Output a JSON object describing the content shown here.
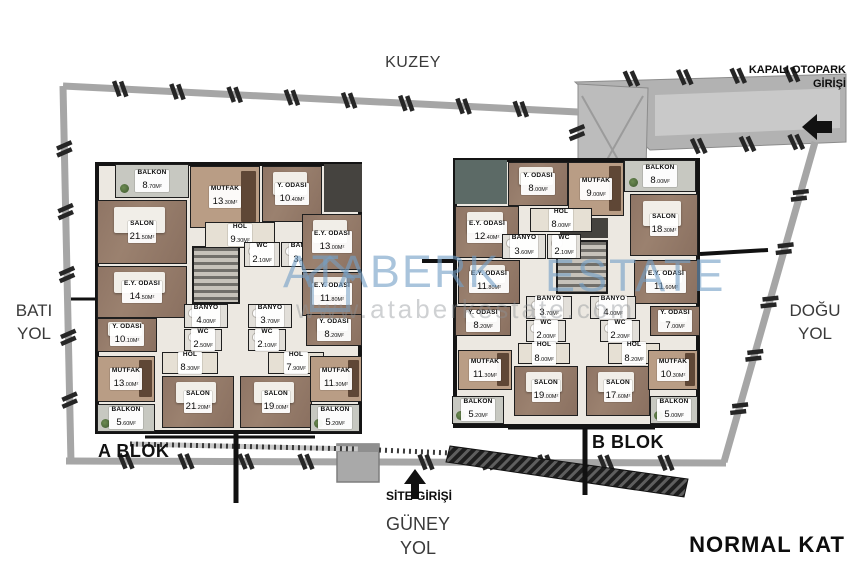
{
  "plan": {
    "title": "NORMAL KAT"
  },
  "directions": {
    "north": "KUZEY",
    "south_line1": "GÜNEY",
    "south_line2": "YOL",
    "west_line1": "BATI",
    "west_line2": "YOL",
    "east_line1": "DOĞU",
    "east_line2": "YOL"
  },
  "entrances": {
    "parking_line1": "KAPALI OTOPARK",
    "parking_line2": "GİRİŞİ",
    "site": "SİTE GİRİŞİ"
  },
  "watermark": {
    "brand": "ATABERK",
    "brand2": "ESTATE",
    "url": "www.ataberkestate.com",
    "color": "#74a0c6"
  },
  "blocks": [
    {
      "name": "A BLOK",
      "label_pos": {
        "x": 98,
        "y": 441
      },
      "outline": {
        "x": 95,
        "y": 162,
        "w": 267,
        "h": 272
      },
      "core": {
        "x": 192,
        "y": 246,
        "w": 48,
        "h": 58
      },
      "rooms": [
        {
          "n": "BALKON",
          "a": "8.70M²",
          "x": 115,
          "y": 164,
          "w": 74,
          "h": 34,
          "t": "balcony"
        },
        {
          "n": "MUTFAK",
          "a": "13.30M²",
          "x": 190,
          "y": 166,
          "w": 70,
          "h": 62,
          "t": "kitchen"
        },
        {
          "n": "Y. ODASI",
          "a": "10.40M²",
          "x": 262,
          "y": 166,
          "w": 60,
          "h": 56,
          "t": "wood"
        },
        {
          "n": "SALON",
          "a": "21.50M²",
          "x": 97,
          "y": 200,
          "w": 90,
          "h": 64,
          "t": "wood"
        },
        {
          "n": "HOL",
          "a": "9.30M²",
          "x": 205,
          "y": 222,
          "w": 70,
          "h": 26,
          "t": "hall"
        },
        {
          "n": "WC",
          "a": "2.10M²",
          "x": 244,
          "y": 242,
          "w": 36,
          "h": 25,
          "t": "wet"
        },
        {
          "n": "BANYO",
          "a": "3.40M²",
          "x": 281,
          "y": 242,
          "w": 44,
          "h": 25,
          "t": "wet"
        },
        {
          "n": "E.Y. ODASI",
          "a": "13.00M²",
          "x": 302,
          "y": 214,
          "w": 60,
          "h": 56,
          "t": "wood"
        },
        {
          "n": "E.Y. ODASI",
          "a": "14.50M²",
          "x": 97,
          "y": 266,
          "w": 90,
          "h": 52,
          "t": "wood"
        },
        {
          "n": "E.Y. ODASI",
          "a": "11.80M²",
          "x": 302,
          "y": 272,
          "w": 60,
          "h": 44,
          "t": "wood"
        },
        {
          "n": "Y. ODASI",
          "a": "10.10M²",
          "x": 97,
          "y": 318,
          "w": 60,
          "h": 34,
          "t": "wood"
        },
        {
          "n": "BANYO",
          "a": "4.00M²",
          "x": 184,
          "y": 304,
          "w": 44,
          "h": 24,
          "t": "wet"
        },
        {
          "n": "WC",
          "a": "2.50M²",
          "x": 184,
          "y": 329,
          "w": 38,
          "h": 22,
          "t": "wet"
        },
        {
          "n": "HOL",
          "a": "8.30M²",
          "x": 162,
          "y": 352,
          "w": 56,
          "h": 22,
          "t": "hall"
        },
        {
          "n": "BANYO",
          "a": "3.70M²",
          "x": 248,
          "y": 304,
          "w": 44,
          "h": 24,
          "t": "wet"
        },
        {
          "n": "WC",
          "a": "2.10M²",
          "x": 248,
          "y": 329,
          "w": 38,
          "h": 22,
          "t": "wet"
        },
        {
          "n": "HOL",
          "a": "7.90M²",
          "x": 268,
          "y": 352,
          "w": 56,
          "h": 22,
          "t": "hall"
        },
        {
          "n": "Y. ODASI",
          "a": "8.20M²",
          "x": 306,
          "y": 314,
          "w": 56,
          "h": 32,
          "t": "wood"
        },
        {
          "n": "MUTFAK",
          "a": "13.00M²",
          "x": 97,
          "y": 356,
          "w": 58,
          "h": 46,
          "t": "kitchen"
        },
        {
          "n": "SALON",
          "a": "21.20M²",
          "x": 162,
          "y": 376,
          "w": 72,
          "h": 52,
          "t": "wood"
        },
        {
          "n": "SALON",
          "a": "19.00M²",
          "x": 240,
          "y": 376,
          "w": 72,
          "h": 52,
          "t": "wood"
        },
        {
          "n": "MUTFAK",
          "a": "11.30M²",
          "x": 310,
          "y": 356,
          "w": 52,
          "h": 46,
          "t": "kitchen"
        },
        {
          "n": "BALKON",
          "a": "5.60M²",
          "x": 97,
          "y": 404,
          "w": 58,
          "h": 28,
          "t": "balcony"
        },
        {
          "n": "BALKON",
          "a": "5.20M²",
          "x": 310,
          "y": 404,
          "w": 50,
          "h": 28,
          "t": "balcony"
        }
      ]
    },
    {
      "name": "B BLOK",
      "label_pos": {
        "x": 592,
        "y": 432
      },
      "outline": {
        "x": 453,
        "y": 158,
        "w": 247,
        "h": 270
      },
      "core": {
        "x": 556,
        "y": 240,
        "w": 52,
        "h": 54
      },
      "rooms": [
        {
          "n": "Y. ODASI",
          "a": "8.00M²",
          "x": 508,
          "y": 162,
          "w": 60,
          "h": 44,
          "t": "wood"
        },
        {
          "n": "MUTFAK",
          "a": "9.00M²",
          "x": 568,
          "y": 162,
          "w": 56,
          "h": 54,
          "t": "kitchen"
        },
        {
          "n": "BALKON",
          "a": "8.00M²",
          "x": 624,
          "y": 160,
          "w": 72,
          "h": 32,
          "t": "balcony"
        },
        {
          "n": "E.Y. ODASI",
          "a": "12.40M²",
          "x": 455,
          "y": 206,
          "w": 64,
          "h": 52,
          "t": "wood"
        },
        {
          "n": "HOL",
          "a": "8.00M²",
          "x": 530,
          "y": 208,
          "w": 62,
          "h": 24,
          "t": "hall"
        },
        {
          "n": "BANYO",
          "a": "3.60M²",
          "x": 502,
          "y": 234,
          "w": 44,
          "h": 25,
          "t": "wet"
        },
        {
          "n": "WC",
          "a": "2.10M²",
          "x": 547,
          "y": 234,
          "w": 34,
          "h": 25,
          "t": "wet"
        },
        {
          "n": "SALON",
          "a": "18.30M²",
          "x": 630,
          "y": 194,
          "w": 68,
          "h": 62,
          "t": "wood"
        },
        {
          "n": "E.Y. ODASI",
          "a": "11.80M²",
          "x": 458,
          "y": 260,
          "w": 62,
          "h": 44,
          "t": "wood"
        },
        {
          "n": "E.Y. ODASI",
          "a": "11.60M²",
          "x": 634,
          "y": 260,
          "w": 64,
          "h": 44,
          "t": "wood"
        },
        {
          "n": "Y. ODASI",
          "a": "8.20M²",
          "x": 455,
          "y": 306,
          "w": 56,
          "h": 30,
          "t": "wood"
        },
        {
          "n": "BANYO",
          "a": "3.70M²",
          "x": 526,
          "y": 296,
          "w": 46,
          "h": 23,
          "t": "wet"
        },
        {
          "n": "WC",
          "a": "2.00M²",
          "x": 526,
          "y": 320,
          "w": 40,
          "h": 22,
          "t": "wet"
        },
        {
          "n": "HOL",
          "a": "8.00M²",
          "x": 518,
          "y": 343,
          "w": 52,
          "h": 21,
          "t": "hall"
        },
        {
          "n": "BANYO",
          "a": "4.00M²",
          "x": 590,
          "y": 296,
          "w": 46,
          "h": 23,
          "t": "wet"
        },
        {
          "n": "WC",
          "a": "2.20M²",
          "x": 600,
          "y": 320,
          "w": 40,
          "h": 22,
          "t": "wet"
        },
        {
          "n": "HOL",
          "a": "8.20M²",
          "x": 608,
          "y": 343,
          "w": 52,
          "h": 21,
          "t": "hall"
        },
        {
          "n": "Y. ODASI",
          "a": "7.00M²",
          "x": 650,
          "y": 306,
          "w": 50,
          "h": 30,
          "t": "wood"
        },
        {
          "n": "MUTFAK",
          "a": "11.30M²",
          "x": 458,
          "y": 350,
          "w": 54,
          "h": 40,
          "t": "kitchen"
        },
        {
          "n": "SALON",
          "a": "19.00M²",
          "x": 514,
          "y": 366,
          "w": 64,
          "h": 50,
          "t": "wood"
        },
        {
          "n": "SALON",
          "a": "17.60M²",
          "x": 586,
          "y": 366,
          "w": 64,
          "h": 50,
          "t": "wood"
        },
        {
          "n": "MUTFAK",
          "a": "10.30M²",
          "x": 648,
          "y": 350,
          "w": 50,
          "h": 40,
          "t": "kitchen"
        },
        {
          "n": "BALKON",
          "a": "5.20M²",
          "x": 452,
          "y": 396,
          "w": 52,
          "h": 28,
          "t": "balcony"
        },
        {
          "n": "BALKON",
          "a": "5.00M²",
          "x": 650,
          "y": 396,
          "w": 48,
          "h": 28,
          "t": "balcony"
        }
      ]
    }
  ]
}
